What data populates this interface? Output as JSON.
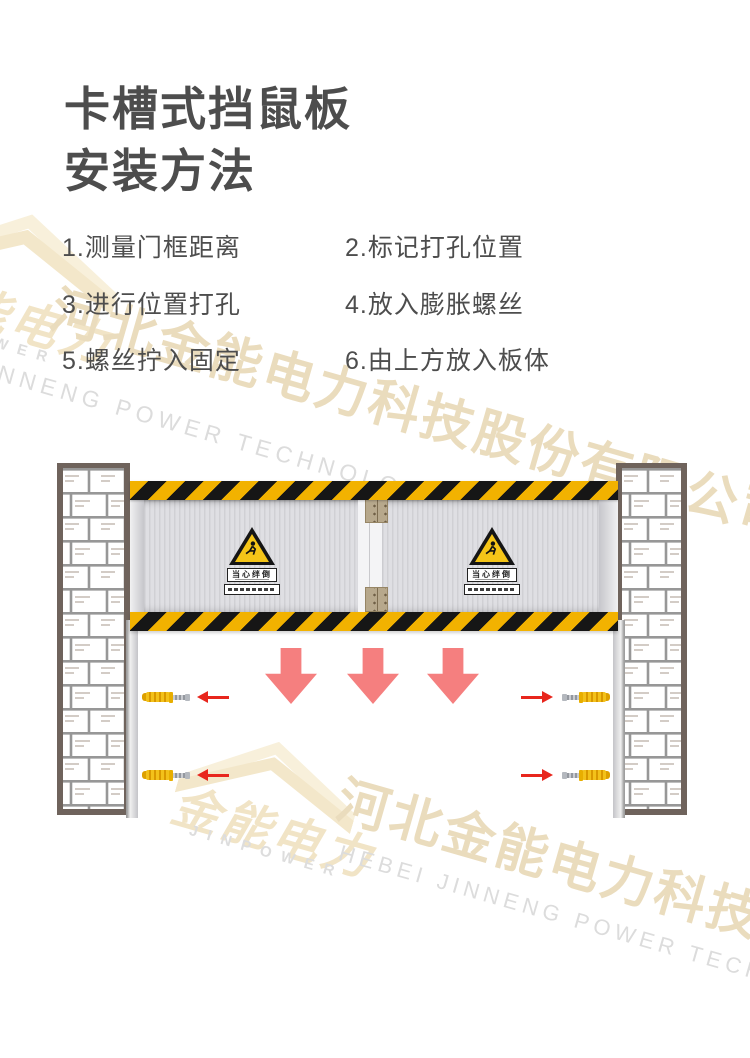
{
  "title": {
    "line1": "卡槽式挡鼠板",
    "line2": "安装方法"
  },
  "steps": [
    {
      "label": "1.测量门框距离"
    },
    {
      "label": "2.标记打孔位置"
    },
    {
      "label": "3.进行位置打孔"
    },
    {
      "label": "4.放入膨胀螺丝"
    },
    {
      "label": "5.螺丝拧入固定"
    },
    {
      "label": "6.由上方放入板体"
    }
  ],
  "diagram": {
    "warning_sign_label": "当心绊倒"
  },
  "watermark": {
    "logo_cn": "金能电力",
    "logo_en": "JINPOWER",
    "company_cn": "河北金能电力科技股份有限公司",
    "company_en": "HEBEI JINNENG POWER TECHNOLOGY CO.,LTD"
  },
  "colors": {
    "heading_text": "#4d4d4d",
    "hazard_yellow": "#f2b200",
    "hazard_black": "#161616",
    "wall_border": "#6f635c",
    "brick_line": "#979797",
    "arrow_salmon": "#f57f7f",
    "arrow_red": "#e8261d",
    "anchor_yellow": "#f3c11a",
    "watermark_tan": "#eadcbd",
    "watermark_gray": "#dcdcdc"
  }
}
